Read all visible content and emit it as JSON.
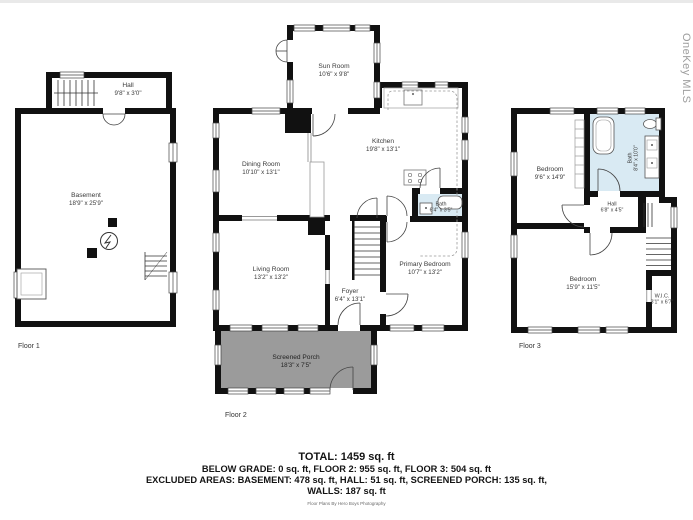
{
  "meta": {
    "watermark": "OneKey MLS",
    "credit": "Floor Plans By Hero Boys Photography"
  },
  "floors": {
    "floor1": {
      "label": "Floor 1"
    },
    "floor2": {
      "label": "Floor 2"
    },
    "floor3": {
      "label": "Floor 3"
    }
  },
  "rooms": {
    "f1_hall": {
      "name": "Hall",
      "dims": "9'8\" x 3'0\""
    },
    "f1_basement": {
      "name": "Basement",
      "dims": "18'9\" x 25'9\""
    },
    "f2_sun_room": {
      "name": "Sun Room",
      "dims": "10'6\" x 9'8\""
    },
    "f2_kitchen": {
      "name": "Kitchen",
      "dims": "19'8\" x 13'1\""
    },
    "f2_dining_room": {
      "name": "Dining Room",
      "dims": "10'10\" x 13'1\""
    },
    "f2_bath": {
      "name": "Bath",
      "dims": "6'4\" x 3'5\""
    },
    "f2_living_room": {
      "name": "Living Room",
      "dims": "13'2\" x 13'2\""
    },
    "f2_primary_bedroom": {
      "name": "Primary Bedroom",
      "dims": "10'7\" x 13'2\""
    },
    "f2_foyer": {
      "name": "Foyer",
      "dims": "6'4\" x 13'1\""
    },
    "f2_screened_porch": {
      "name": "Screened Porch",
      "dims": "18'3\" x 7'5\""
    },
    "f3_bedroom_top": {
      "name": "Bedroom",
      "dims": "9'6\" x 14'9\""
    },
    "f3_bath": {
      "name": "Bath",
      "dims": "8'4\" x 10'0\""
    },
    "f3_hall": {
      "name": "Hall",
      "dims": "6'8\" x 4'5\""
    },
    "f3_bedroom_bottom": {
      "name": "Bedroom",
      "dims": "15'9\" x 11'5\""
    },
    "f3_wic": {
      "name": "W.I.C.",
      "dims": "3'1\" x 6'7\""
    }
  },
  "summary": {
    "total": "TOTAL: 1459 sq. ft",
    "line2": "BELOW GRADE: 0 sq. ft, FLOOR 2: 955 sq. ft, FLOOR 3: 504 sq. ft",
    "line3": "EXCLUDED AREAS: BASEMENT: 478 sq. ft, HALL: 51 sq. ft, SCREENED PORCH: 135 sq. ft,",
    "line4": "WALLS: 187 sq. ft"
  },
  "colors": {
    "wall": "#111111",
    "bath_fill": "#d9eaf3",
    "porch_fill": "#9b9b9b"
  }
}
